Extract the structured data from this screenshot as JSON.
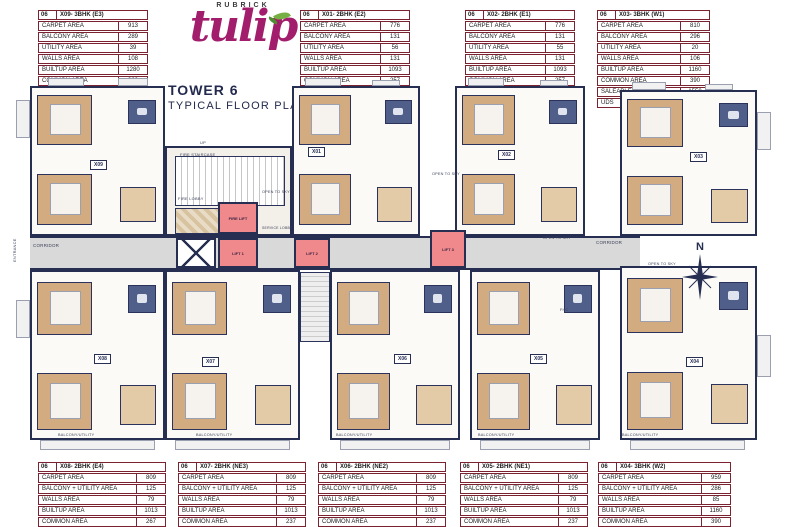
{
  "header": {
    "brand": "RUBRICK",
    "logo_name": "tulip",
    "title_line1": "TOWER 6",
    "title_line2": "TYPICAL FLOOR PLAN"
  },
  "colors": {
    "wall_navy": "#262e52",
    "table_maroon": "#7a2230",
    "lift_pink": "#f0898c",
    "floor_tan": "#d2ab80",
    "bath_blue": "#4f5f8a",
    "corridor_gray": "#d9d9d9",
    "logo_magenta": "#a21d6b",
    "leaf_green": "#76b043"
  },
  "top_tables": [
    {
      "no": "06",
      "name": "X09- 3BHK (E3)",
      "rows": [
        {
          "label": "CARPET AREA",
          "value": "913"
        },
        {
          "label": "BALCONY AREA",
          "value": "289"
        },
        {
          "label": "UTILITY AREA",
          "value": "39"
        },
        {
          "label": "WALLS AREA",
          "value": "108"
        },
        {
          "label": "BUILTUP AREA",
          "value": "1280"
        },
        {
          "label": "COMMON AREA",
          "value": "362"
        },
        {
          "label": "SALEABLE AREA",
          "value": "1650"
        },
        {
          "label": "UDS",
          "value": "40"
        }
      ]
    },
    {
      "no": "06",
      "name": "X01- 2BHK (E2)",
      "rows": [
        {
          "label": "CARPET AREA",
          "value": "776"
        },
        {
          "label": "BALCONY AREA",
          "value": "131"
        },
        {
          "label": "UTILITY AREA",
          "value": "56"
        },
        {
          "label": "WALLS AREA",
          "value": "131"
        },
        {
          "label": "BUILTUP AREA",
          "value": "1093"
        },
        {
          "label": "COMMON AREA",
          "value": "257"
        },
        {
          "label": "SALEABLE AREA",
          "value": "1350"
        },
        {
          "label": "UDS",
          "value": "32"
        }
      ]
    },
    {
      "no": "06",
      "name": "X02- 2BHK (E1)",
      "rows": [
        {
          "label": "CARPET AREA",
          "value": "776"
        },
        {
          "label": "BALCONY AREA",
          "value": "131"
        },
        {
          "label": "UTILITY AREA",
          "value": "55"
        },
        {
          "label": "WALLS AREA",
          "value": "131"
        },
        {
          "label": "BUILTUP AREA",
          "value": "1093"
        },
        {
          "label": "COMMON AREA",
          "value": "257"
        },
        {
          "label": "SALEABLE AREA",
          "value": "1350"
        },
        {
          "label": "UDS",
          "value": "32"
        }
      ]
    },
    {
      "no": "06",
      "name": "X03- 3BHK (W1)",
      "rows": [
        {
          "label": "CARPET AREA",
          "value": "810"
        },
        {
          "label": "BALCONY AREA",
          "value": "296"
        },
        {
          "label": "UTILITY AREA",
          "value": "20"
        },
        {
          "label": "WALLS AREA",
          "value": "106"
        },
        {
          "label": "BUILTUP AREA",
          "value": "1160"
        },
        {
          "label": "COMMON AREA",
          "value": "390"
        },
        {
          "label": "SALEABLE AREA",
          "value": "1550"
        },
        {
          "label": "UDS",
          "value": "41"
        }
      ]
    }
  ],
  "bottom_tables": [
    {
      "no": "06",
      "name": "X08- 2BHK (E4)",
      "rows": [
        {
          "label": "CARPET AREA",
          "value": "809"
        },
        {
          "label": "BALCONY + UTILITY AREA",
          "value": "125"
        },
        {
          "label": "WALLS AREA",
          "value": "79"
        },
        {
          "label": "BUILTUP AREA",
          "value": "1013"
        },
        {
          "label": "COMMON AREA",
          "value": "267"
        },
        {
          "label": "SALEABLE AREA",
          "value": "1280"
        },
        {
          "label": "UDS",
          "value": "32"
        }
      ]
    },
    {
      "no": "06",
      "name": "X07- 2BHK (NE3)",
      "rows": [
        {
          "label": "CARPET AREA",
          "value": "809"
        },
        {
          "label": "BALCONY + UTILITY AREA",
          "value": "125"
        },
        {
          "label": "WALLS AREA",
          "value": "79"
        },
        {
          "label": "BUILTUP AREA",
          "value": "1013"
        },
        {
          "label": "COMMON AREA",
          "value": "237"
        },
        {
          "label": "SALEABLE AREA",
          "value": "1250"
        },
        {
          "label": "UDS",
          "value": "31"
        }
      ]
    },
    {
      "no": "06",
      "name": "X06- 2BHK (NE2)",
      "rows": [
        {
          "label": "CARPET AREA",
          "value": "809"
        },
        {
          "label": "BALCONY + UTILITY AREA",
          "value": "125"
        },
        {
          "label": "WALLS AREA",
          "value": "79"
        },
        {
          "label": "BUILTUP AREA",
          "value": "1013"
        },
        {
          "label": "COMMON AREA",
          "value": "237"
        },
        {
          "label": "SALEABLE AREA",
          "value": "1250"
        },
        {
          "label": "UDS",
          "value": "31"
        }
      ]
    },
    {
      "no": "06",
      "name": "X05- 2BHK (NE1)",
      "rows": [
        {
          "label": "CARPET AREA",
          "value": "809"
        },
        {
          "label": "BALCONY + UTILITY AREA",
          "value": "125"
        },
        {
          "label": "WALLS AREA",
          "value": "79"
        },
        {
          "label": "BUILTUP AREA",
          "value": "1013"
        },
        {
          "label": "COMMON AREA",
          "value": "237"
        },
        {
          "label": "SALEABLE AREA",
          "value": "1250"
        },
        {
          "label": "UDS",
          "value": "31"
        }
      ]
    },
    {
      "no": "06",
      "name": "X04- 3BHK (W2)",
      "rows": [
        {
          "label": "CARPET AREA",
          "value": "959"
        },
        {
          "label": "BALCONY + UTILITY AREA",
          "value": "286"
        },
        {
          "label": "WALLS AREA",
          "value": "85"
        },
        {
          "label": "BUILTUP AREA",
          "value": "1160"
        },
        {
          "label": "COMMON AREA",
          "value": "390"
        },
        {
          "label": "SALEABLE AREA",
          "value": "1550"
        },
        {
          "label": "UDS",
          "value": "41"
        }
      ]
    }
  ],
  "plan": {
    "compass_n": "N",
    "unit_labels": [
      {
        "id": "X09",
        "x": 90,
        "y": 160
      },
      {
        "id": "X01",
        "x": 308,
        "y": 147
      },
      {
        "id": "X02",
        "x": 498,
        "y": 150
      },
      {
        "id": "X03",
        "x": 690,
        "y": 152
      },
      {
        "id": "X08",
        "x": 94,
        "y": 354
      },
      {
        "id": "X07",
        "x": 202,
        "y": 357
      },
      {
        "id": "X06",
        "x": 394,
        "y": 354
      },
      {
        "id": "X05",
        "x": 530,
        "y": 354
      },
      {
        "id": "X04",
        "x": 686,
        "y": 357
      }
    ],
    "lifts": [
      {
        "label": "FIRE LIFT",
        "x": 218,
        "y": 202,
        "w": 40,
        "h": 32
      },
      {
        "label": "LIFT 1",
        "x": 218,
        "y": 238,
        "w": 40,
        "h": 30
      },
      {
        "label": "LIFT 2",
        "x": 294,
        "y": 238,
        "w": 36,
        "h": 30
      },
      {
        "label": "LIFT 3",
        "x": 430,
        "y": 230,
        "w": 36,
        "h": 38
      }
    ],
    "labels": [
      {
        "text": "UP",
        "x": 200,
        "y": 140,
        "fs": 4
      },
      {
        "text": "FIRE STAIRCASE",
        "x": 180,
        "y": 152,
        "fs": 4
      },
      {
        "text": "FIRE LOBBY",
        "x": 178,
        "y": 196,
        "fs": 4
      },
      {
        "text": "SERVICE LOBBY",
        "x": 262,
        "y": 226,
        "fs": 3.5
      },
      {
        "text": "CORRIDOR",
        "x": 33,
        "y": 243,
        "fs": 4.5
      },
      {
        "text": "CORRIDOR",
        "x": 596,
        "y": 240,
        "fs": 4.5
      },
      {
        "text": "OPEN TO SKY",
        "x": 262,
        "y": 190,
        "fs": 3.8
      },
      {
        "text": "OPEN TO SKY",
        "x": 432,
        "y": 172,
        "fs": 3.8
      },
      {
        "text": "OPEN TO SKY",
        "x": 543,
        "y": 236,
        "fs": 3.8
      },
      {
        "text": "OPEN TO SKY",
        "x": 648,
        "y": 262,
        "fs": 3.8
      },
      {
        "text": "ENTRANCE",
        "x": 12,
        "y": 262,
        "fs": 4,
        "rot": -90
      },
      {
        "text": "FHC",
        "x": 560,
        "y": 308,
        "fs": 3.8
      },
      {
        "text": "BALCONY/UTILITY",
        "x": 58,
        "y": 433,
        "fs": 3.8
      },
      {
        "text": "BALCONY/UTILITY",
        "x": 196,
        "y": 433,
        "fs": 3.8
      },
      {
        "text": "BALCONY/UTILITY",
        "x": 336,
        "y": 433,
        "fs": 3.8
      },
      {
        "text": "BALCONY/UTILITY",
        "x": 478,
        "y": 433,
        "fs": 3.8
      },
      {
        "text": "BALCONY/UTILITY",
        "x": 622,
        "y": 433,
        "fs": 3.8
      }
    ]
  }
}
